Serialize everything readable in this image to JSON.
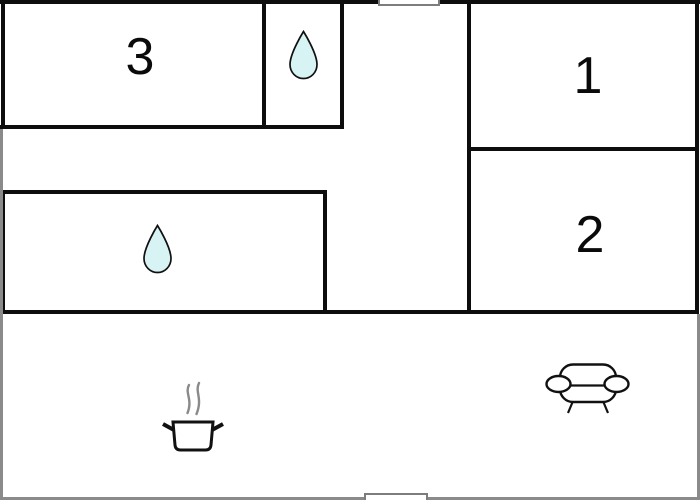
{
  "title": "apartment-floor-plan",
  "colors": {
    "background": "#ffffff",
    "wall": "#0d0d0d",
    "edge_gray": "#8a8a8a",
    "window_gray": "#7d7d7d",
    "water_drop_fill": "#d8f3f4",
    "steam_gray": "#8a8a8a",
    "label": "#0a0a0a"
  },
  "rooms": {
    "room1": {
      "label": "1"
    },
    "room2": {
      "label": "2"
    },
    "room3": {
      "label": "3"
    }
  },
  "icons": {
    "water_drop_top": "water-drop-icon",
    "water_drop_middle": "water-drop-icon",
    "cooking_pot": "cooking-pot-icon",
    "sofa": "sofa-icon"
  }
}
